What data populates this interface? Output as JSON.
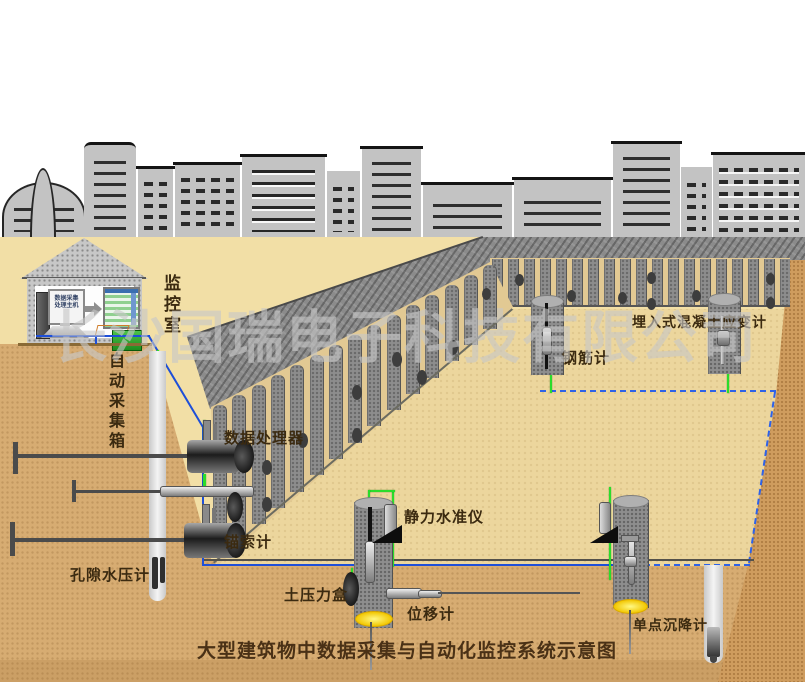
{
  "title": "大型建筑物中数据采集与自动化监控系统示意图",
  "watermark": "长沙国瑞电子科技有限公司",
  "labels": {
    "monitor_room": "监控室",
    "auto_collect_box": "自动采集箱",
    "data_processor": "数据处理器",
    "anchor_gauge": "锚索计",
    "pore_pressure_gauge": "孔隙水压计",
    "earth_pressure_cell": "土压力盒",
    "displacement_meter": "位移计",
    "static_level": "静力水准仪",
    "rebar_gauge": "钢筋计",
    "embedded_strain_gauge": "埋入式混凝土应变计",
    "settlement_gauge": "单点沉降计",
    "host_line1": "数据采集",
    "host_line2": "处理主机"
  },
  "colors": {
    "surface": "#f2dfa6",
    "underground": "#d7ac72",
    "floor": "#ecd69d",
    "wall_gray": "#8d8d8d",
    "slope_band": "#cf9c5e",
    "cable_blue": "#1e4fd8",
    "cable_green": "#2bdc2b",
    "dashed_blue": "#2e62e8",
    "flange_yellow": "#ffd91e",
    "building_gray": "#c3c3c3",
    "label_brown": "#3b2a10",
    "title_brown": "#4a3116",
    "watermark_gray": "#c8c8c8",
    "green_box": "#2fae2f"
  }
}
